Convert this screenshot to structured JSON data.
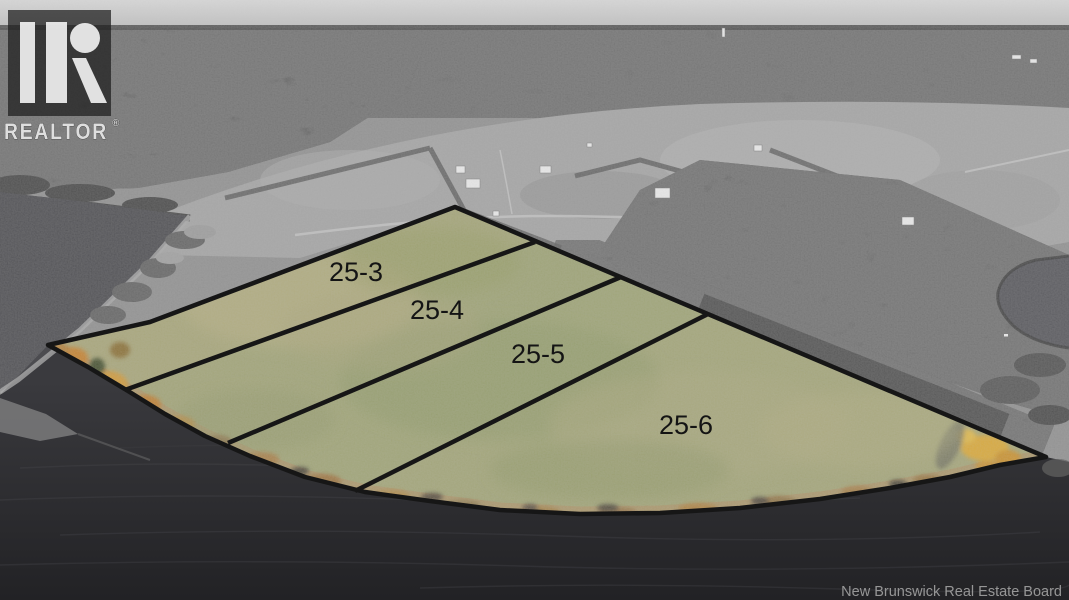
{
  "watermark": {
    "brand": "REALTOR",
    "registered_symbol": "®",
    "logo_icon": "realtor-block-r-logo"
  },
  "lots": [
    {
      "label": "25-3"
    },
    {
      "label": "25-4"
    },
    {
      "label": "25-5"
    },
    {
      "label": "25-6"
    }
  ],
  "attribution": {
    "text": "New Brunswick Real Estate Board"
  },
  "colors": {
    "lot_grass": "#a0a478",
    "lot_boundary": "#161616",
    "autumn_foliage": "#cd9338",
    "water_dark": "#2a2a2d",
    "water_inlet": "#4c4c50",
    "grayscale_land": "#8f8f8f",
    "sky_haze": "#d0d0d0",
    "label_text": "#141414",
    "watermark_text": "#dedede",
    "attribution_text": "#a0a0a0"
  }
}
